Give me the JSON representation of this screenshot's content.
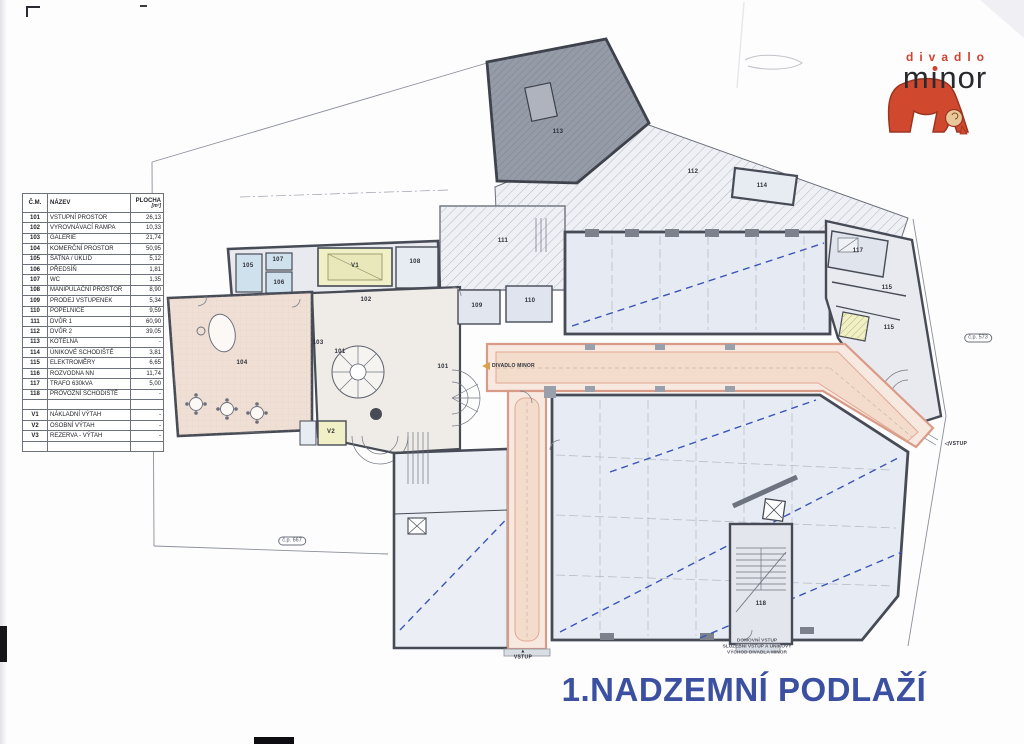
{
  "page": {
    "title": "1.NADZEMNÍ PODLAŽÍ",
    "title_color": "#3c50a2"
  },
  "logo": {
    "top_text": "divadlo",
    "bottom_text": "minor",
    "red": "#cf4130"
  },
  "legend": {
    "headers": {
      "col1": "Č.M.",
      "col2": "NÁZEV",
      "col3_line1": "PLOCHA",
      "col3_line2": "[m²]"
    },
    "rows": [
      {
        "cm": "101",
        "nazev": "VSTUPNÍ PROSTOR",
        "plocha": "26,13"
      },
      {
        "cm": "102",
        "nazev": "VYROVNÁVACÍ RAMPA",
        "plocha": "10,33"
      },
      {
        "cm": "103",
        "nazev": "GALERIE",
        "plocha": "21,74"
      },
      {
        "cm": "104",
        "nazev": "KOMERČNÍ PROSTOR",
        "plocha": "50,95"
      },
      {
        "cm": "105",
        "nazev": "ŠATNA / ÚKLID",
        "plocha": "5,12"
      },
      {
        "cm": "106",
        "nazev": "PŘEDSÍŇ",
        "plocha": "1,81"
      },
      {
        "cm": "107",
        "nazev": "WC",
        "plocha": "1,35"
      },
      {
        "cm": "108",
        "nazev": "MANIPULAČNÍ PROSTOR",
        "plocha": "8,90"
      },
      {
        "cm": "109",
        "nazev": "PRODEJ VSTUPENEK",
        "plocha": "5,34"
      },
      {
        "cm": "110",
        "nazev": "POPELNICE",
        "plocha": "9,59"
      },
      {
        "cm": "111",
        "nazev": "DVŮR 1",
        "plocha": "60,90"
      },
      {
        "cm": "112",
        "nazev": "DVŮR 2",
        "plocha": "39,05"
      },
      {
        "cm": "113",
        "nazev": "KOTELNA",
        "plocha": "-"
      },
      {
        "cm": "114",
        "nazev": "ÚNIKOVÉ SCHODIŠTĚ",
        "plocha": "3,81"
      },
      {
        "cm": "115",
        "nazev": "ELEKTROMĚRY",
        "plocha": "6,65"
      },
      {
        "cm": "116",
        "nazev": "ROZVODNA NN",
        "plocha": "11,74"
      },
      {
        "cm": "117",
        "nazev": "TRAFO 630kVA",
        "plocha": "5,00"
      },
      {
        "cm": "118",
        "nazev": "PROVOZNÍ SCHODIŠTĚ",
        "plocha": "-"
      },
      {
        "cm": "",
        "nazev": "",
        "plocha": ""
      },
      {
        "cm": "V1",
        "nazev": "NÁKLADNÍ VÝTAH",
        "plocha": "-"
      },
      {
        "cm": "V2",
        "nazev": "OSOBNÍ VÝTAH",
        "plocha": "-"
      },
      {
        "cm": "V3",
        "nazev": "REZERVA - VÝTAH",
        "plocha": "-"
      },
      {
        "cm": "",
        "nazev": "",
        "plocha": ""
      }
    ]
  },
  "plan": {
    "corridor_sign": {
      "text": "DIVADLO MINOR"
    },
    "room_labels": [
      {
        "text": "101",
        "x": 340,
        "y": 352
      },
      {
        "text": "101",
        "x": 443,
        "y": 367
      },
      {
        "text": "102",
        "x": 366,
        "y": 300
      },
      {
        "text": "103",
        "x": 318,
        "y": 343
      },
      {
        "text": "104",
        "x": 242,
        "y": 363
      },
      {
        "text": "105",
        "x": 248,
        "y": 266
      },
      {
        "text": "107",
        "x": 278,
        "y": 260
      },
      {
        "text": "106",
        "x": 279,
        "y": 283
      },
      {
        "text": "108",
        "x": 415,
        "y": 262
      },
      {
        "text": "109",
        "x": 477,
        "y": 306
      },
      {
        "text": "110",
        "x": 530,
        "y": 301
      },
      {
        "text": "111",
        "x": 503,
        "y": 241
      },
      {
        "text": "112",
        "x": 693,
        "y": 172
      },
      {
        "text": "113",
        "x": 558,
        "y": 132
      },
      {
        "text": "114",
        "x": 762,
        "y": 186
      },
      {
        "text": "115",
        "x": 887,
        "y": 288
      },
      {
        "text": "115",
        "x": 889,
        "y": 328
      },
      {
        "text": "117",
        "x": 858,
        "y": 251
      },
      {
        "text": "118",
        "x": 761,
        "y": 604
      },
      {
        "text": "V1",
        "x": 355,
        "y": 266
      },
      {
        "text": "V2",
        "x": 331,
        "y": 432
      }
    ],
    "oval_labels": [
      {
        "text": "č.p. 573",
        "x": 978,
        "y": 338
      },
      {
        "text": "č.p. 667",
        "x": 292,
        "y": 541
      }
    ],
    "entrances": [
      {
        "text": "VSTUP",
        "x": 523,
        "y": 655,
        "dir": "up"
      },
      {
        "text": "VSTUP",
        "x": 956,
        "y": 444,
        "dir": "left"
      }
    ],
    "note": {
      "lines": [
        "DOMOVNÍ VSTUP",
        "SLUŽEBNÍ VSTUP A ÚNIKOVÝ",
        "VÝCHOD DIVADLA MINOR"
      ],
      "x": 757,
      "y": 647
    }
  }
}
